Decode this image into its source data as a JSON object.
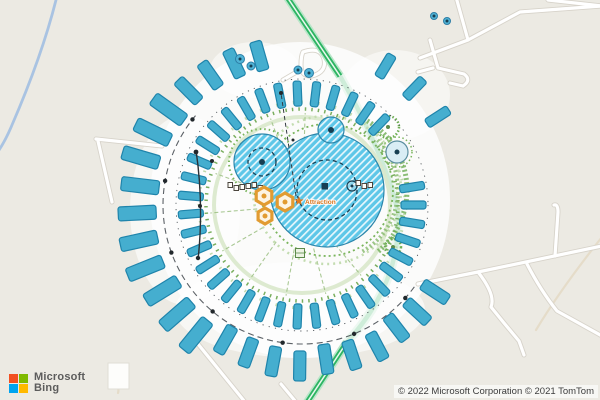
{
  "branding": {
    "microsoft": "Microsoft",
    "bing": "Bing",
    "logo_colors": [
      "#f25022",
      "#7fba00",
      "#00a4ef",
      "#ffb900"
    ]
  },
  "attribution": {
    "copyright": "© 2022 Microsoft Corporation © 2021 TomTom"
  },
  "map": {
    "background": "#eceae3",
    "halo_color": "#ffffff",
    "halos": [
      [
        300,
        200,
        150,
        158,
        0.8
      ],
      [
        185,
        210,
        55,
        95,
        0.6
      ],
      [
        300,
        310,
        125,
        48,
        0.6
      ],
      [
        395,
        95,
        55,
        45,
        0.5
      ],
      [
        255,
        70,
        45,
        28,
        0.5
      ]
    ],
    "river": {
      "color": "#a9c3e2",
      "width": 2.8,
      "path": "M 57,-4 C 45,45 25,95 12,125 C 7,137 2,146 -3,153"
    },
    "roads": {
      "casing": "#d7d3ca",
      "fill": "#ffffff",
      "casing_width": 5,
      "fill_width": 3.2,
      "paths": [
        "M 602,6 L 548,0 M 602,6 L 520,12 L 468,40 L 420,58",
        "M 468,40 L 456,-3",
        "M 430,40 L 438,68 L 464,74 Q 472,80 463,86 L 450,83",
        "M 418,72 L 433,68",
        "M 418,284 L 478,272 L 602,246",
        "M 478,272 Q 496,295 491,307 L 504,323 L 519,341 L 524,355",
        "M 527,264 Q 541,291 557,311 L 602,336",
        "M 555,256 L 558,212 Q 558,204 554,205",
        "M 96,139 L 162,146",
        "M 98,141 L 112,202",
        "M 198,344 L 245,402",
        "M 281,384 L 296,402",
        "M 303,52 Q 320,46 324,59 Q 327,72 312,76 Q 301,77 301,65 Q 301,56 303,52 Z",
        "M 283,80 L 300,70"
      ],
      "faint_color": "#e5dcc9",
      "faint_paths": [
        "M 602,237 Q 560,290 536,330",
        "M 112,381 Q 120,386 118,393 M 122,379 L 126,388"
      ]
    },
    "buildings_plain": [
      [
        108,
        363,
        21,
        26
      ]
    ],
    "highway": {
      "halo": "#b9e6c9",
      "main": "#2db563",
      "center_line": "#eaf8ef",
      "solid": [
        "M 285,-6 L 340,76",
        "M 347,342 L 306,404"
      ],
      "tunnel": "M 340,76 Q 385,155 398,212 Q 402,282 347,342"
    },
    "complex": {
      "cx": 302,
      "cy": 205,
      "building_fill": "#45aecf",
      "building_stroke": "#1f84ab",
      "inner_ring": {
        "r_inner": 99,
        "r_outer": 124,
        "count": 39,
        "bar_width": 8,
        "gap_start": 14,
        "gap_end": 44
      },
      "outer_ring": {
        "start": 106,
        "end": 328,
        "step": 9.6,
        "big_arc": [
          140,
          235
        ],
        "big_len": 38,
        "big_w": 14,
        "big_rmid": 166,
        "len": 30,
        "w": 12,
        "rmid": 158
      },
      "outer_extra": {
        "angles": [
          33,
          46,
          59
        ],
        "rmid": 162,
        "len": 26,
        "w": 10
      },
      "tree_color": "#79ae5e",
      "tree_light": "#b9d6a4",
      "path_green": "#d9e8cb",
      "spoke_color": "#9cc083",
      "spoke_angles": [
        88,
        110,
        135,
        160,
        185,
        210,
        235,
        260,
        285,
        310
      ],
      "dark": "#333a40",
      "pond_fill": "#5ec7e8",
      "pond_stroke": "#2c85aa",
      "pond_dark": "#173f53",
      "ponds": [
        {
          "cx": 327,
          "cy": 190,
          "r": 57,
          "hatched": true,
          "dash_ring": 30,
          "center_square": true,
          "small_ring": [
            352,
            186
          ]
        },
        {
          "cx": 262,
          "cy": 162,
          "r": 28,
          "hatched": true,
          "dash_ring": 14,
          "center_dot": 3
        },
        {
          "cx": 331,
          "cy": 130,
          "r": 13,
          "hatched": true,
          "center_dot": 3
        },
        {
          "cx": 397,
          "cy": 152,
          "r": 11,
          "hatched": false,
          "pale": true,
          "center_dot": 2.5,
          "green_ring": 15
        }
      ],
      "green_circles": [
        [
          388,
          127,
          11
        ],
        [
          393,
          247,
          8
        ]
      ],
      "plaza": [
        300,
        253,
        9
      ],
      "structure_rows": [
        [
          228,
          184,
          6
        ],
        [
          356,
          182,
          3
        ]
      ],
      "blue_dots": [
        [
          240,
          59,
          4.5
        ],
        [
          251,
          66,
          4
        ],
        [
          298,
          70,
          4
        ],
        [
          309,
          73,
          4.5
        ],
        [
          434,
          16,
          3.5
        ],
        [
          447,
          21,
          3.5
        ]
      ]
    },
    "poi": {
      "ring_color": "#e29b31",
      "ring_fill": "#fdf4e4",
      "clusters": [
        [
          264,
          196,
          9
        ],
        [
          285,
          202,
          9
        ],
        [
          265,
          216,
          8
        ]
      ],
      "star": [
        299,
        201
      ],
      "star_color": "#e07b1f",
      "label": "Attraction",
      "label_color": "#d8731a",
      "label_pos": [
        305,
        204
      ]
    }
  }
}
